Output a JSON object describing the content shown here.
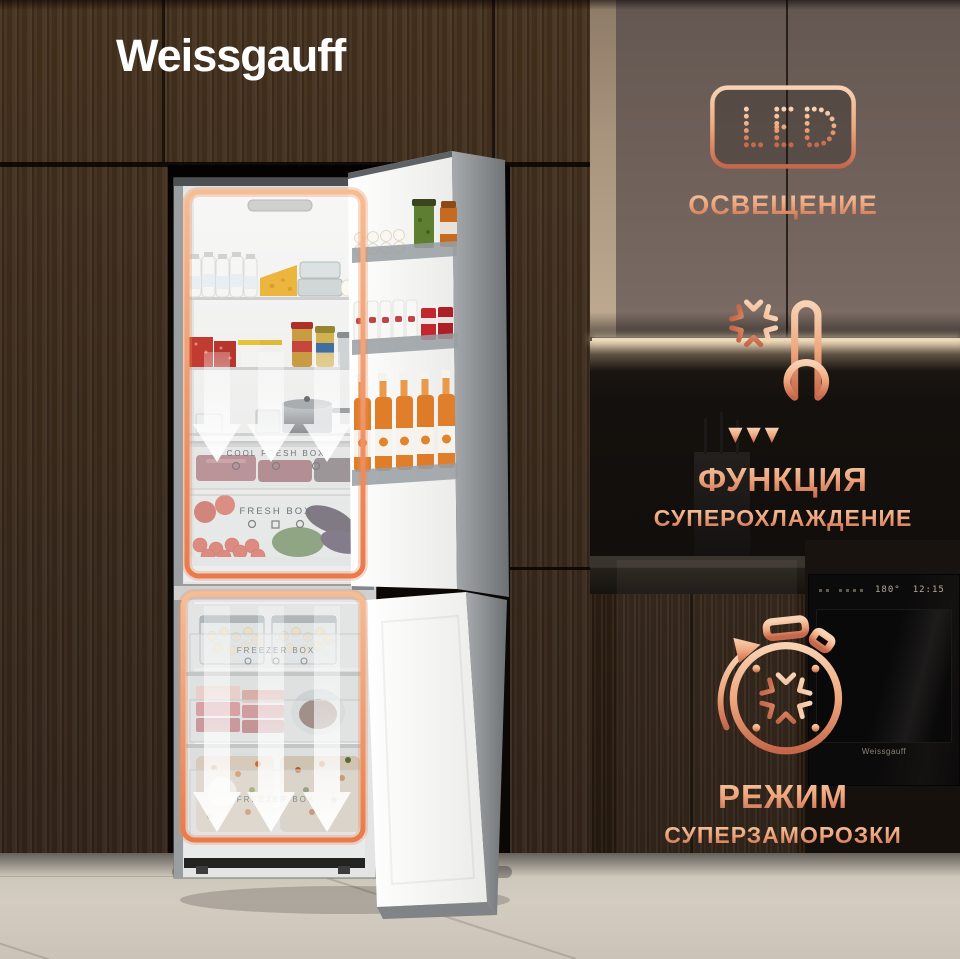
{
  "brand": {
    "logo_text": "Weissgauff"
  },
  "features": [
    {
      "badge_text": "LED",
      "title": "ОСВЕЩЕНИЕ"
    },
    {
      "title": "ФУНКЦИЯ",
      "subtitle": "СУПЕРОХЛАЖДЕНИЕ"
    },
    {
      "title": "РЕЖИМ",
      "subtitle": "СУПЕРЗАМОРОЗКИ"
    }
  ],
  "fridge": {
    "labels": {
      "cool_fresh_box": "COOL FRESH BOX",
      "fresh_box": "FRESH BOX",
      "freezer_box_top": "FREEZER BOX",
      "freezer_box_bottom": "FREEZER BOX"
    }
  },
  "oven": {
    "temperature": "180°",
    "time": "12:15",
    "brand_label": "Weissgauff"
  },
  "colors": {
    "accent_highlight": "#EE8F62",
    "copper_light": "#F6C9A8",
    "copper_dark": "#C5674A",
    "logo_white": "#FFFFFF"
  }
}
